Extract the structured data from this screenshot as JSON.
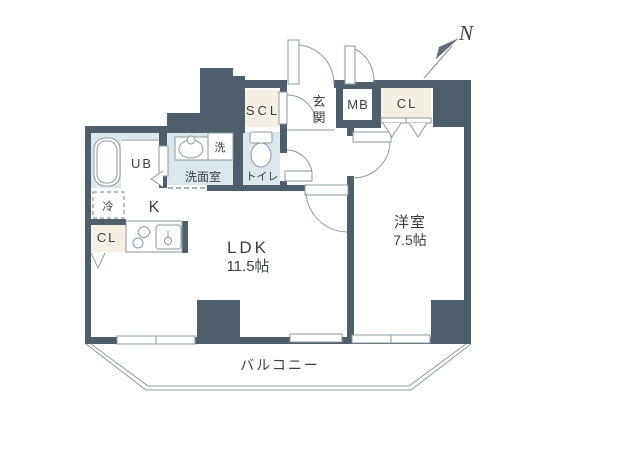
{
  "title": "1LDK floor plan",
  "colors": {
    "wall": "#4e5e6a",
    "wet": "#dce7ec",
    "closet": "#f5eee3",
    "line": "#8b9aa2",
    "text": "#3a4046",
    "arrow": "#5f6e78"
  },
  "compass": {
    "north_label": "N"
  },
  "rooms": {
    "ldk": {
      "name": "LDK",
      "size": "11.5帖"
    },
    "western_room": {
      "name": "洋室",
      "size": "7.5帖"
    },
    "balcony": {
      "name": "バルコニー"
    },
    "kitchen": {
      "name": "K"
    },
    "entrance": {
      "name": "玄関",
      "chars": [
        "玄",
        "関"
      ]
    },
    "washroom": {
      "name": "洗面室"
    },
    "toilet": {
      "name": "トイレ"
    },
    "unit_bath": {
      "name": "UB"
    },
    "shoe_closet": {
      "name": "SCL"
    },
    "meter_box": {
      "name": "MB"
    },
    "closet_bedroom": {
      "name": "CL"
    },
    "closet_kitchen": {
      "name": "CL"
    },
    "washer_space": {
      "name": "洗"
    },
    "fridge_space": {
      "name": "冷"
    }
  }
}
